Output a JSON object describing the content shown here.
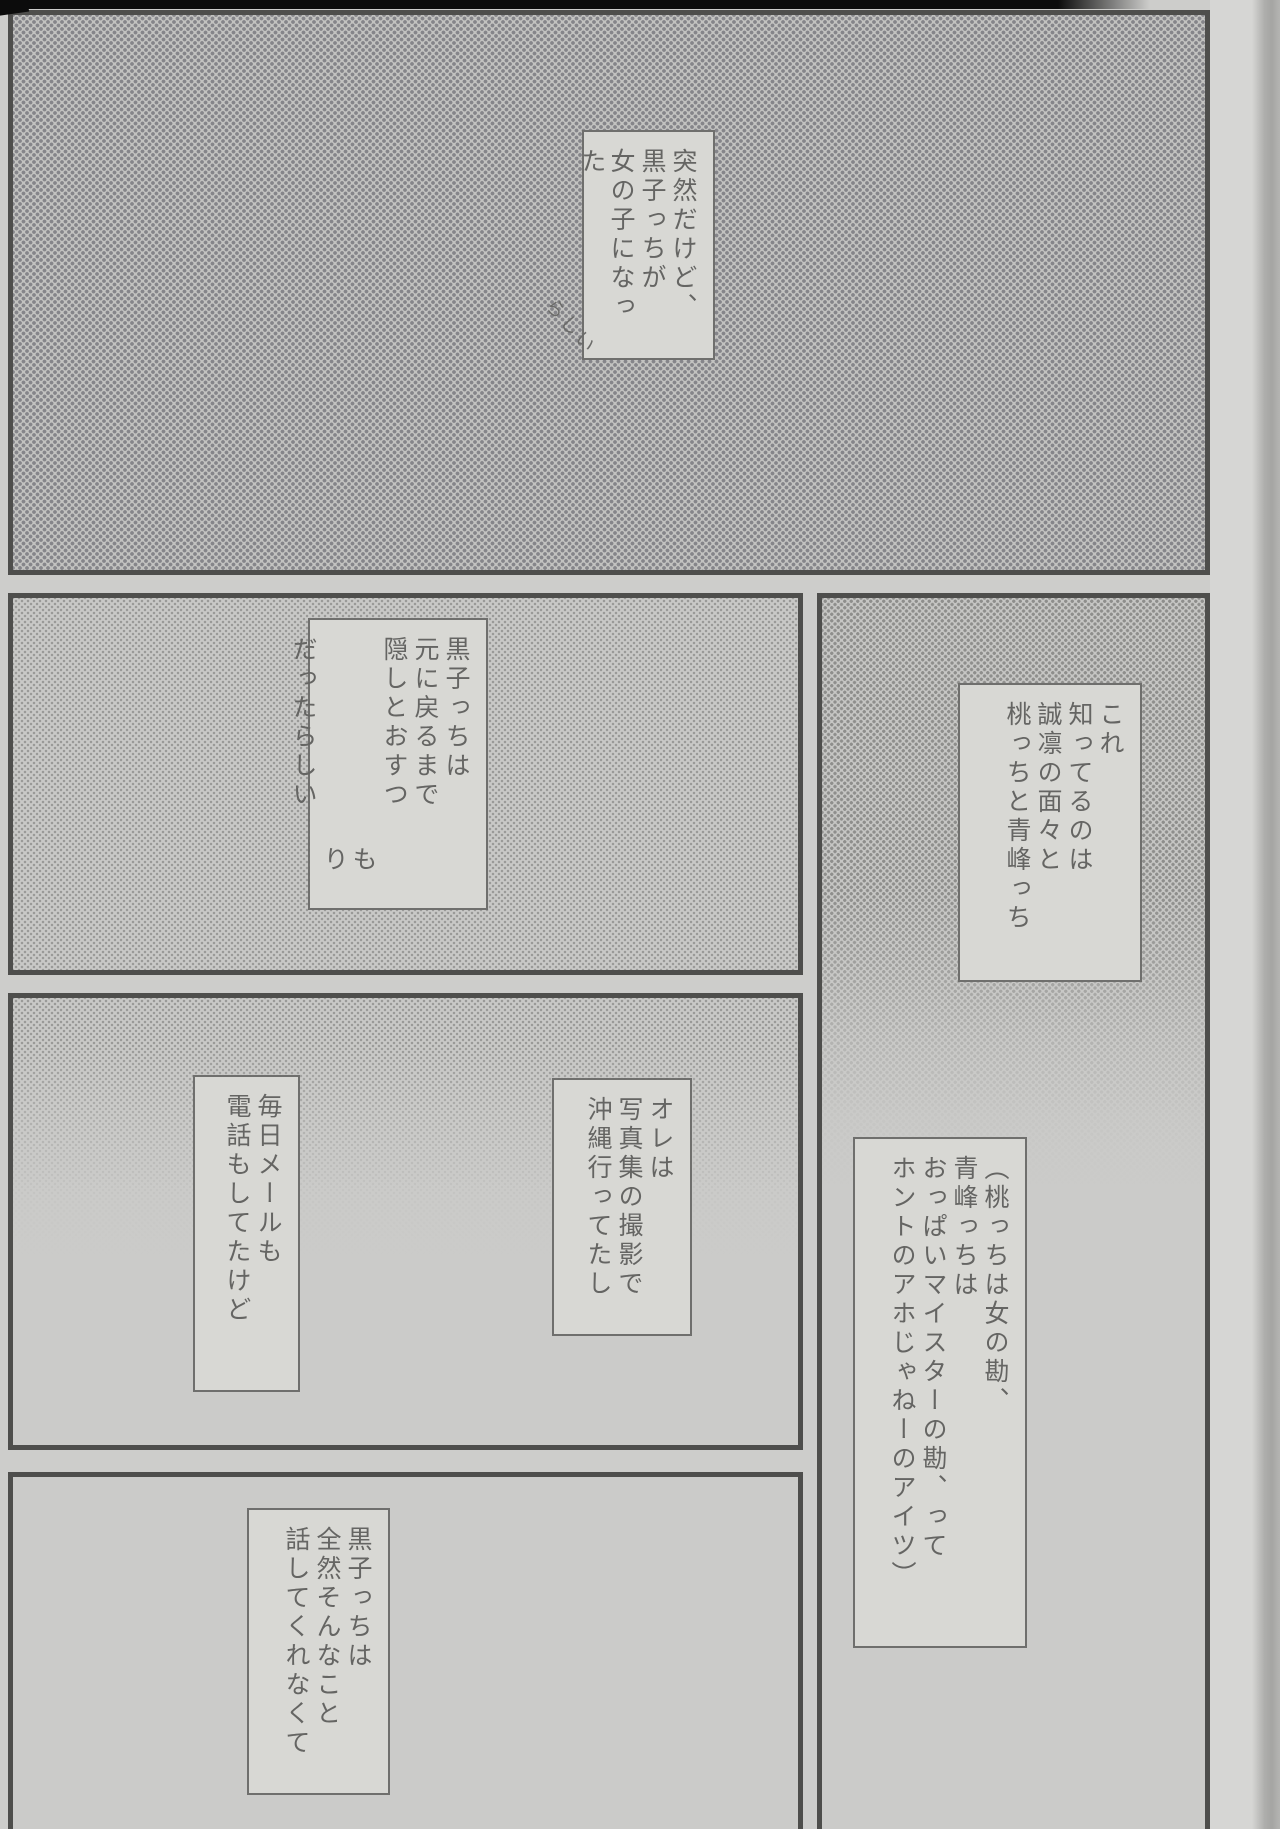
{
  "page_type": "manga-scan-page",
  "colors": {
    "paper": "#cdcdcb",
    "panel_border": "#4e4e4c",
    "speech_box_border": "#6f6f6d",
    "speech_box_fill": "#d8d8d4",
    "text": "#656563",
    "halftone_dot_dark": "#85858a",
    "halftone_dot_fine": "#9a9a98",
    "scan_edge_black": "#0c0c0c",
    "page_margin_light": "#d6d6d4",
    "book_edge_shadow": "#a5a5a3"
  },
  "balloons": {
    "intro": {
      "columns": [
        "突然だけど、",
        "黒子っちが",
        "女の子になった"
      ],
      "annotation": "らしい"
    },
    "hiding": {
      "columns": [
        "黒子っちは",
        "元に戻るまで",
        "隠しとおすつ",
        {
          "t": "もり",
          "drop": true
        },
        "だったらしい"
      ]
    },
    "who_knows": {
      "columns": [
        "これ",
        "知ってるのは",
        "誠凛の面々と",
        "桃っちと青峰っち"
      ]
    },
    "daily_mail": {
      "columns": [
        "毎日メールも",
        "電話もしてたけど"
      ]
    },
    "okinawa": {
      "columns": [
        "オレは",
        "写真集の撮影で",
        "沖縄行ってたし"
      ]
    },
    "momoi_aomine": {
      "columns": [
        "（桃っちは女の勘、",
        "青峰っちは",
        "おっぱいマイスターの勘、って",
        "ホントのアホじゃねーのアイツ）"
      ]
    },
    "kuroko_silent": {
      "columns": [
        "黒子っちは",
        "全然そんなこと",
        "話してくれなくて"
      ]
    }
  }
}
